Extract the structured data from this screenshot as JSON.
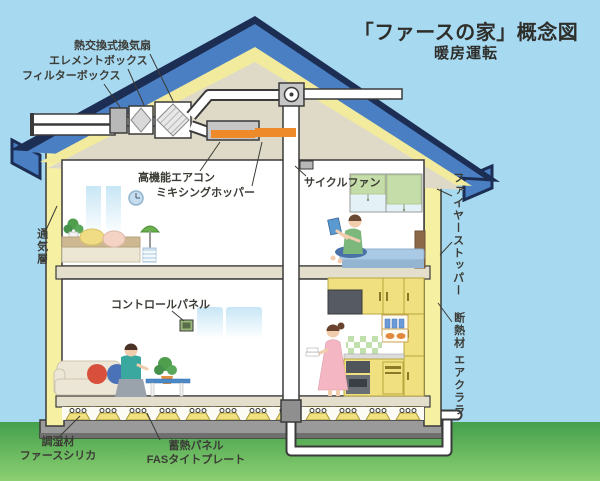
{
  "title": {
    "main": "「ファースの家」概念図",
    "sub": "暖房運転"
  },
  "labels": {
    "heat_exchange_fan": "熱交換式換気扇",
    "element_box": "エレメントボックス",
    "filter_box": "フィルターボックス",
    "high_function_aircon": "高機能エアコン",
    "mixing_hopper": "ミキシングホッパー",
    "cycle_fan": "サイクルファン",
    "fire_stopper": "ファイヤーストッパー",
    "ventilation_layer": "通気層",
    "control_panel": "コントロールパネル",
    "insulation_material": "断熱材",
    "insulation_brand": "エアクララ",
    "humidity_material": "調湿材",
    "humidity_brand": "ファースシリカ",
    "heat_storage_panel": "蓄熱パネル",
    "heat_storage_brand": "FASタイトプレート"
  },
  "colors": {
    "sky": "#a7d9f1",
    "ground_top": "#44a04c",
    "ground_bottom": "#8ccf72",
    "roof_blue": "#4b7fc3",
    "roof_outline": "#1c2e54",
    "roof_insulation_yellow": "#f2eb9e",
    "wall_yellow": "#f5f0a2",
    "attic_beige": "#dedac7",
    "heated_air_orange": "#ef8a2a",
    "foundation_gray": "#9a9a9a",
    "cabinet_yellow": "#f0e080",
    "duct_white": "#ffffff"
  }
}
